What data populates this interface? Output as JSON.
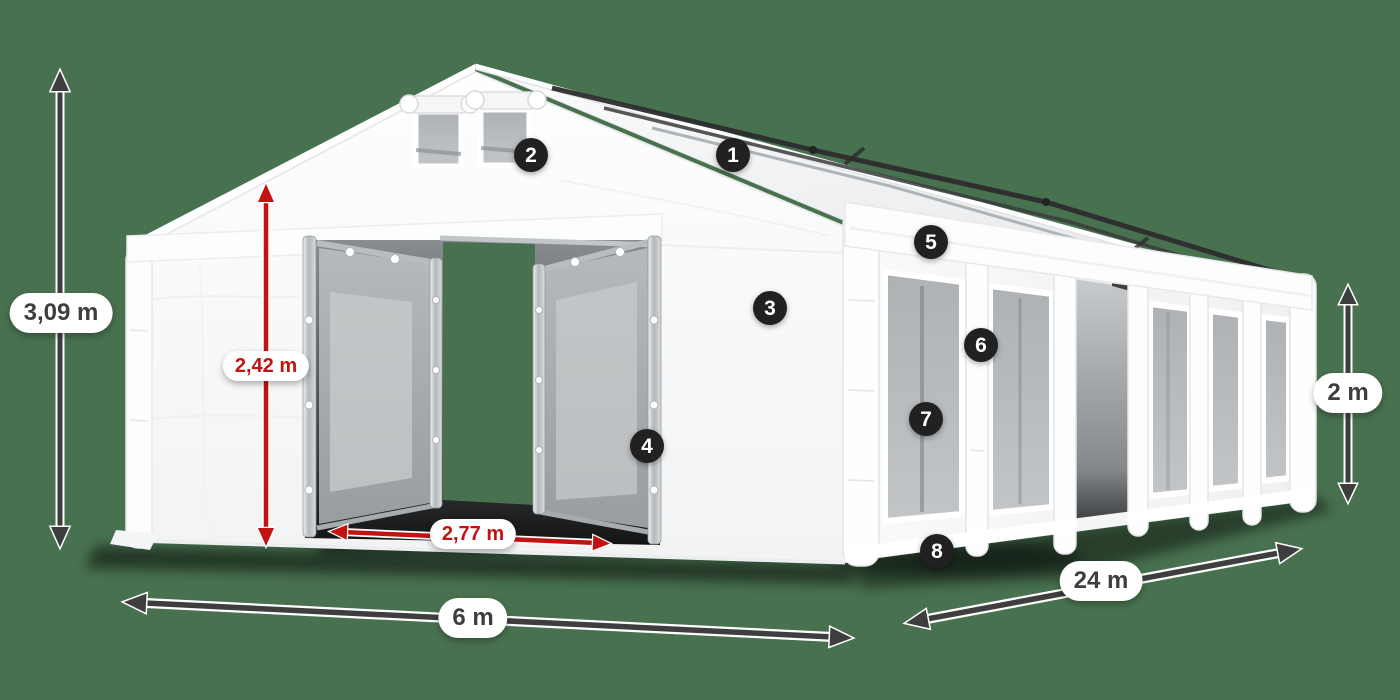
{
  "illustration": {
    "subject": "white storage marquee tent with dimension callouts",
    "background_color": "#48714f"
  },
  "colors": {
    "background": "#48714f",
    "dimension_dark": "#3e3e3e",
    "dimension_red": "#c31212",
    "label_background": "#ffffff",
    "marker_background": "#212121",
    "marker_text": "#ffffff",
    "tent_white": "#fafbfc",
    "window_gray": "#b3b7b9"
  },
  "dimension_labels": [
    {
      "id": "ridge-height",
      "text": "3,09 m",
      "style": "dark"
    },
    {
      "id": "entrance-height",
      "text": "2,42 m",
      "style": "red"
    },
    {
      "id": "entrance-width",
      "text": "2,77 m",
      "style": "red"
    },
    {
      "id": "tent-width",
      "text": "6 m",
      "style": "dark"
    },
    {
      "id": "tent-length",
      "text": "24 m",
      "style": "dark"
    },
    {
      "id": "side-height",
      "text": "2 m",
      "style": "dark"
    }
  ],
  "feature_markers": [
    {
      "number": "1"
    },
    {
      "number": "2"
    },
    {
      "number": "3"
    },
    {
      "number": "4"
    },
    {
      "number": "5"
    },
    {
      "number": "6"
    },
    {
      "number": "7"
    },
    {
      "number": "8"
    }
  ]
}
